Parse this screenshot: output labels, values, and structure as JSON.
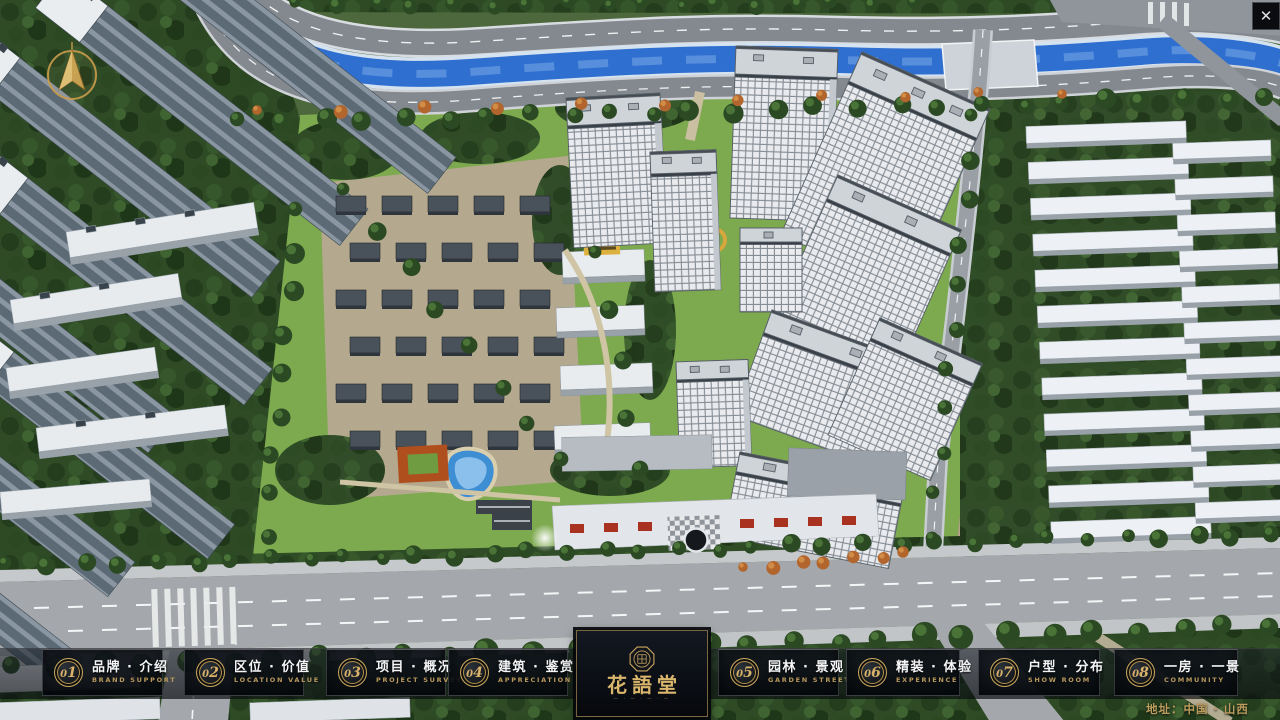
{
  "chrome": {
    "close_icon": "✕"
  },
  "project": {
    "logo_title": "花語堂",
    "logo_tagline": "— · — · — · —",
    "address": "地址：中国 · 山西"
  },
  "menu": {
    "items": [
      {
        "num": "01",
        "label": "品牌 · 介绍",
        "sub": "BRAND SUPPORT"
      },
      {
        "num": "02",
        "label": "区位 · 价值",
        "sub": "LOCATION VALUE"
      },
      {
        "num": "03",
        "label": "项目 · 概况",
        "sub": "PROJECT SURVEY"
      },
      {
        "num": "04",
        "label": "建筑 · 鉴赏",
        "sub": "APPRECIATION"
      },
      {
        "num": "05",
        "label": "园林 · 景观",
        "sub": "GARDEN STREET"
      },
      {
        "num": "06",
        "label": "精装 · 体验",
        "sub": "EXPERIENCE"
      },
      {
        "num": "07",
        "label": "户型 · 分布",
        "sub": "SHOW ROOM"
      },
      {
        "num": "08",
        "label": "一房 · 一景",
        "sub": "COMMUNITY"
      }
    ]
  },
  "colors": {
    "accent_gold": "#c9a65e",
    "bar_background": "#0d1117",
    "river_blue": "#2f6fd0",
    "label_white": "#f3f5f7"
  }
}
